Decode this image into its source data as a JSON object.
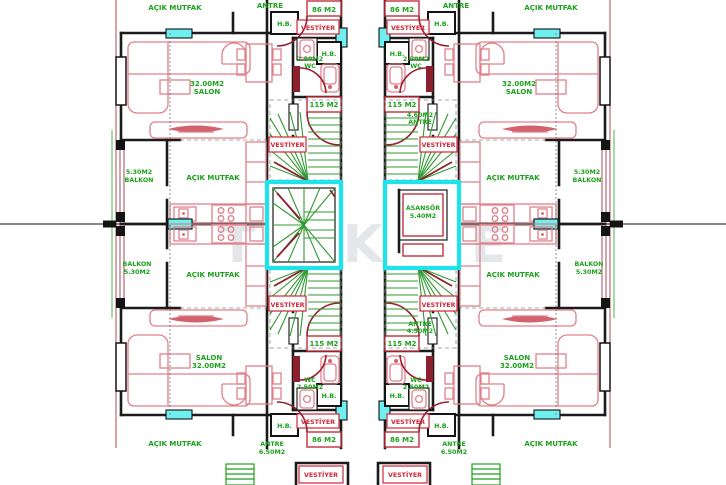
{
  "document": {
    "type": "architectural floor plan",
    "description": "Symmetric twin-block apartment floor plan with four units around central stair and elevator cores",
    "watermark": "TEKCE"
  },
  "colors": {
    "walls": "#1b1b1b",
    "furniture": "#e2808a",
    "doors": "#9a1f2f",
    "room_labels": "#1ca21c",
    "vestiyer_labels": "#d02535",
    "windows_and_core": "#1ee3e8",
    "stair_treads": "#2f9b2f"
  },
  "labels": {
    "acik_mutfak": "AÇIK MUTFAK",
    "antre": "ANTRE",
    "salon": "SALON",
    "balkon": "BALKON",
    "wc": "WC",
    "hb": "H.B.",
    "vestiyer": "VESTİYER",
    "asansor": "ASANSÖR",
    "area_32": "32.00M2",
    "area_530": "5.30M2",
    "area_250": "2.50M2",
    "area_540": "5.40M2",
    "area_460": "4.60M2",
    "area_450": "4.50M2",
    "area_650": "6.50M2",
    "area_86": "86 M2",
    "area_115": "115 M2"
  }
}
